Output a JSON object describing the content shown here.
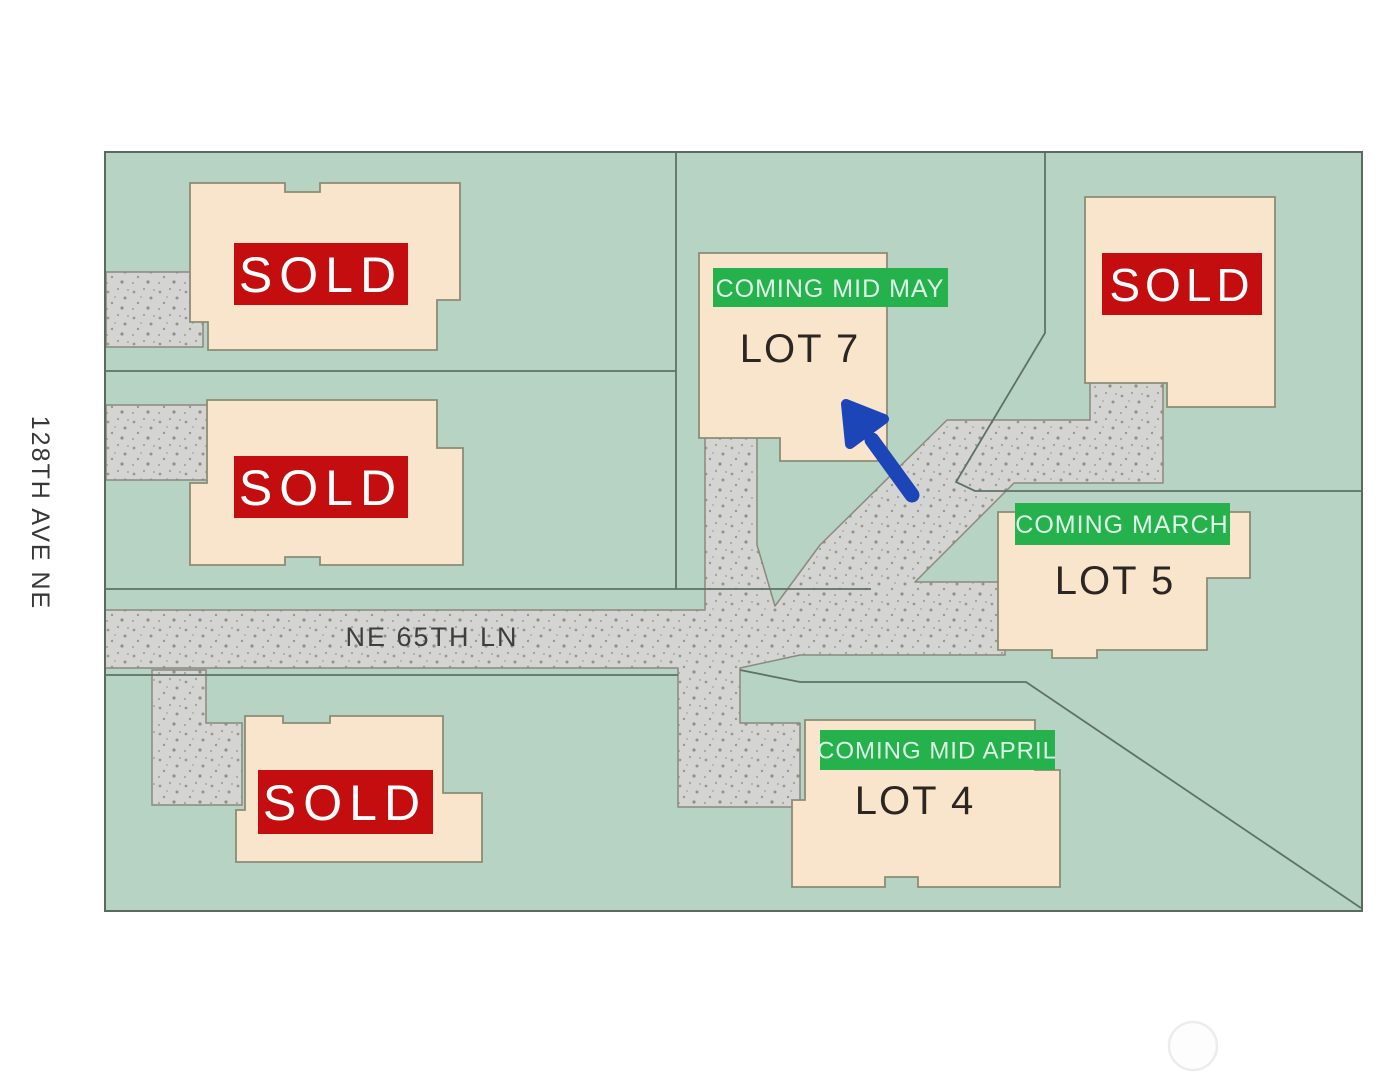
{
  "streets": {
    "vertical": "128TH AVE NE",
    "horizontal": "NE 65TH LN"
  },
  "labels": {
    "sold": "SOLD"
  },
  "lots": {
    "lot7": {
      "name": "LOT 7",
      "badge": "COMING MID MAY"
    },
    "lot5": {
      "name": "LOT 5",
      "badge": "COMING MARCH"
    },
    "lot4": {
      "name": "LOT 4",
      "badge": "COMING MID APRIL"
    }
  },
  "colors": {
    "map_green": "#b7d3c3",
    "map_border": "#5a6a5e",
    "road_gray": "#d4d4d2",
    "road_edge": "#8a8a7e",
    "lot_line": "#5f7265",
    "house_fill": "#f9e5cc",
    "house_edge": "#8c8c76",
    "sold_red": "#c40d0e",
    "badge_green": "#25b14b",
    "arrow_blue": "#1c45b8"
  }
}
